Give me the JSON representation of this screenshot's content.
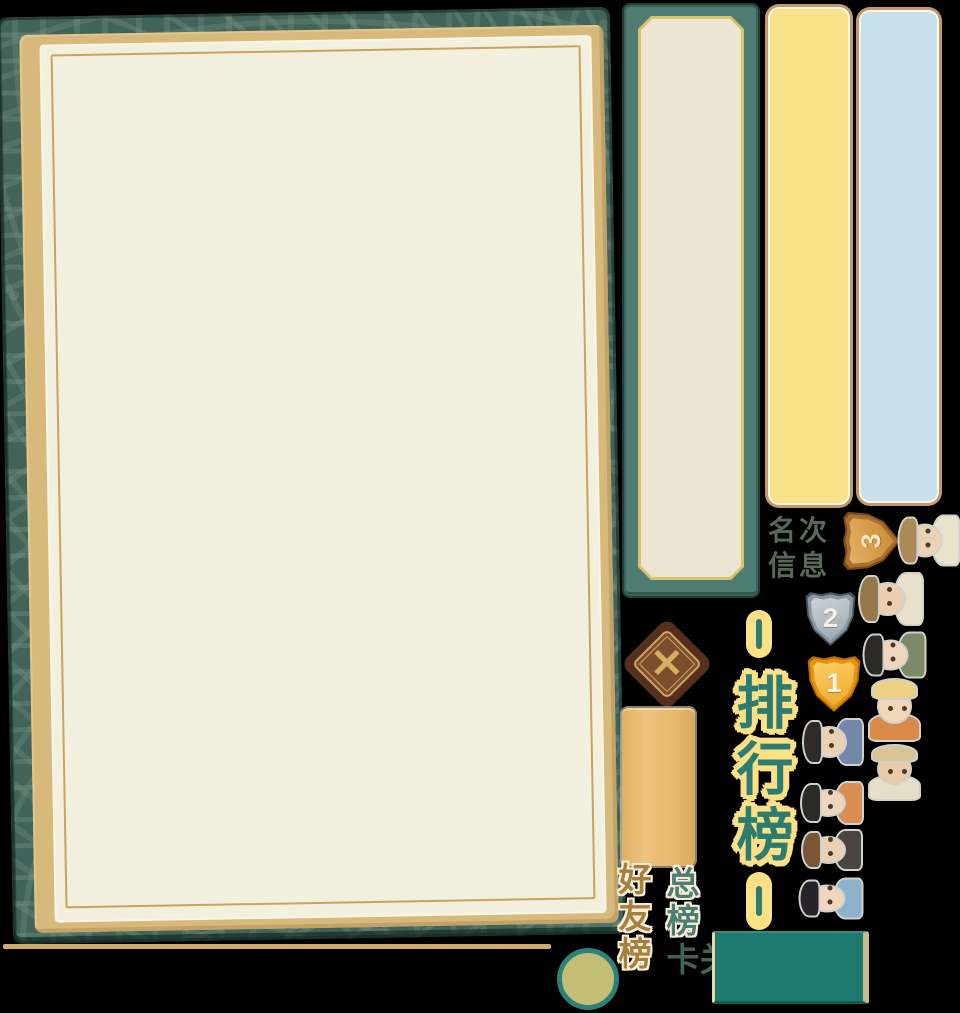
{
  "screen": {
    "name": "leaderboard-sprite-sheet"
  },
  "title": {
    "text": "排行榜",
    "text_color": "#2e7b72",
    "halo_color": "#fbe086"
  },
  "labels": {
    "rank_info_line1": "名次",
    "rank_info_line2": "信息",
    "tab_overall": "总榜",
    "tab_friends": "好友榜",
    "tab_levels": "关卡"
  },
  "close_button": {
    "symbol": "✕"
  },
  "medals": [
    {
      "id": "bronze",
      "rank": "3",
      "x": 840,
      "y": 512,
      "w": 62,
      "h": 58,
      "rot": -90,
      "outline": "#7c4c1d",
      "rim": "#a86f2e",
      "face1": "#e3b269",
      "face2": "#c9892f",
      "num_color": "#f2e3c3"
    },
    {
      "id": "silver",
      "rank": "2",
      "x": 804,
      "y": 591,
      "w": 53,
      "h": 55,
      "rot": 0,
      "outline": "#47545e",
      "rim": "#8a97a1",
      "face1": "#cdd3d8",
      "face2": "#9aa6ae",
      "num_color": "#eef0ee"
    },
    {
      "id": "gold",
      "rank": "1",
      "x": 806,
      "y": 655,
      "w": 56,
      "h": 57,
      "rot": 0,
      "outline": "#b36c07",
      "rim": "#e89310",
      "face1": "#fbd06a",
      "face2": "#efa72a",
      "num_color": "#fdf6e8"
    }
  ],
  "avatars": [
    {
      "id": "elder-straw-hat",
      "desc": "old man with straw hat and grey beard",
      "x": 897,
      "y": 512,
      "w": 63,
      "h": 56,
      "rot": -90,
      "skin": "#ecd2b5",
      "hat": "#ab8a58",
      "clothes": "#e9e3cd"
    },
    {
      "id": "round-hat-man",
      "desc": "man with round brown hat",
      "x": 858,
      "y": 570,
      "w": 66,
      "h": 58,
      "rot": -90,
      "skin": "#eccfae",
      "hat": "#96774a",
      "clothes": "#e8e0c8"
    },
    {
      "id": "green-ribbon-woman",
      "desc": "woman with black hair and green ribbon",
      "x": 862,
      "y": 629,
      "w": 64,
      "h": 51,
      "rot": -90,
      "skin": "#f0d6bd",
      "hat": "#2c2a28",
      "clothes": "#7d8a6a"
    },
    {
      "id": "yellow-cap-man",
      "desc": "smiling man with yellow cap, orange robe",
      "x": 866,
      "y": 678,
      "w": 57,
      "h": 64,
      "rot": 0,
      "skin": "#f2d6b8",
      "hat": "#ecd083",
      "clothes": "#d98a48"
    },
    {
      "id": "official-black-hat",
      "desc": "official with black hat and blue robe",
      "x": 802,
      "y": 716,
      "w": 62,
      "h": 52,
      "rot": -90,
      "skin": "#ecd0b4",
      "hat": "#2e2b28",
      "clothes": "#7487a8"
    },
    {
      "id": "bandana-man",
      "desc": "man with tan bandana and stubble",
      "x": 866,
      "y": 744,
      "w": 57,
      "h": 57,
      "rot": 0,
      "skin": "#e9cba6",
      "hat": "#d8c494",
      "clothes": "#e7dfc8"
    },
    {
      "id": "bun-woman",
      "desc": "woman with hair bun, striped clothes",
      "x": 800,
      "y": 779,
      "w": 64,
      "h": 48,
      "rot": -90,
      "skin": "#f0d6bd",
      "hat": "#2c2a28",
      "clothes": "#d98f52"
    },
    {
      "id": "curly-man",
      "desc": "man with curly brown hair",
      "x": 801,
      "y": 827,
      "w": 62,
      "h": 46,
      "rot": -90,
      "skin": "#ecd0b4",
      "hat": "#7a5636",
      "clothes": "#4a453f"
    },
    {
      "id": "blue-stripe-youth",
      "desc": "young man with blue striped clothes",
      "x": 798,
      "y": 875,
      "w": 65,
      "h": 46,
      "rot": -90,
      "skin": "#f0d6bd",
      "hat": "#26242a",
      "clothes": "#8fb2cc"
    }
  ],
  "palette": {
    "background": "#000000",
    "board_cover_teal": "#42635a",
    "board_frame_tan": "#d7b97c",
    "paper_cream": "#f3f0df",
    "paper_gold_line": "#c9a55c",
    "side_strip_teal": "#4f7c72",
    "side_strip_inner": "#ece5d3",
    "yellow_strip": "#fae189",
    "blue_strip": "#c8dfec",
    "strip_border_tan": "#c6976d",
    "diamond_dark_brown": "#54301c",
    "diamond_mid_brown": "#7d4e2b",
    "tan_button": "#e3b76c",
    "teal_rect": "#1e7a6e",
    "olive_circle": "#c3be74",
    "olive_ring": "#2b8278"
  }
}
